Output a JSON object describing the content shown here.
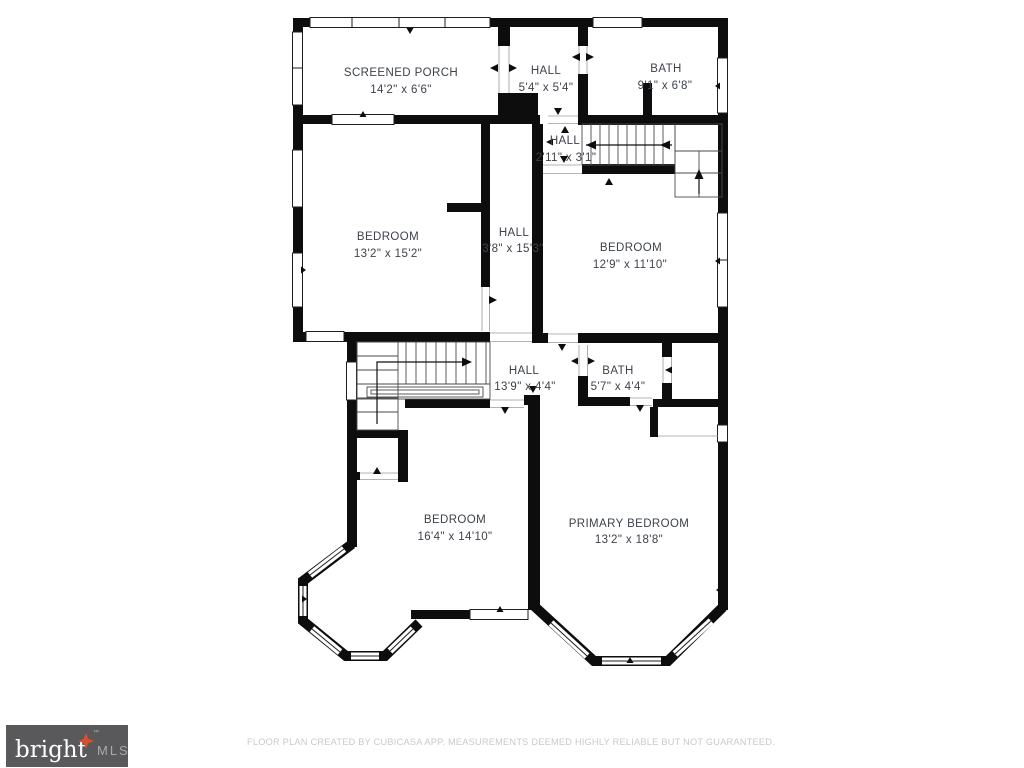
{
  "plan": {
    "rooms": [
      {
        "id": "screened-porch",
        "name": "SCREENED PORCH",
        "dims": "14'2\" x 6'6\""
      },
      {
        "id": "hall-top",
        "name": "HALL",
        "dims": "5'4\" x 5'4\""
      },
      {
        "id": "bath-top",
        "name": "BATH",
        "dims": "9'1\" x 6'8\""
      },
      {
        "id": "hall-small",
        "name": "HALL",
        "dims": "2'11\" x 3'1\""
      },
      {
        "id": "bedroom-left",
        "name": "BEDROOM",
        "dims": "13'2\" x 15'2\""
      },
      {
        "id": "hall-mid",
        "name": "HALL",
        "dims": "3'8\" x 15'3\""
      },
      {
        "id": "bedroom-right",
        "name": "BEDROOM",
        "dims": "12'9\" x 11'10\""
      },
      {
        "id": "hall-lower",
        "name": "HALL",
        "dims": "13'9\" x 4'4\""
      },
      {
        "id": "bath-lower",
        "name": "BATH",
        "dims": "5'7\" x 4'4\""
      },
      {
        "id": "bedroom-bottom",
        "name": "BEDROOM",
        "dims": "16'4\" x 14'10\""
      },
      {
        "id": "primary-bedroom",
        "name": "PRIMARY BEDROOM",
        "dims": "13'2\" x 18'8\""
      }
    ]
  },
  "footer": {
    "logo": {
      "brand": "bright",
      "mls": "MLS",
      "tm": "™"
    },
    "disclaimer": "FLOOR PLAN CREATED BY CUBICASA APP. MEASUREMENTS DEEMED HIGHLY RELIABLE BUT NOT GUARANTEED."
  },
  "colors": {
    "wall": "#0d0d0d",
    "label_text": "#3d424a",
    "logo_background": "#59595b",
    "logo_star": "#d94f2e",
    "disclaimer_text": "#c9c9c9"
  }
}
